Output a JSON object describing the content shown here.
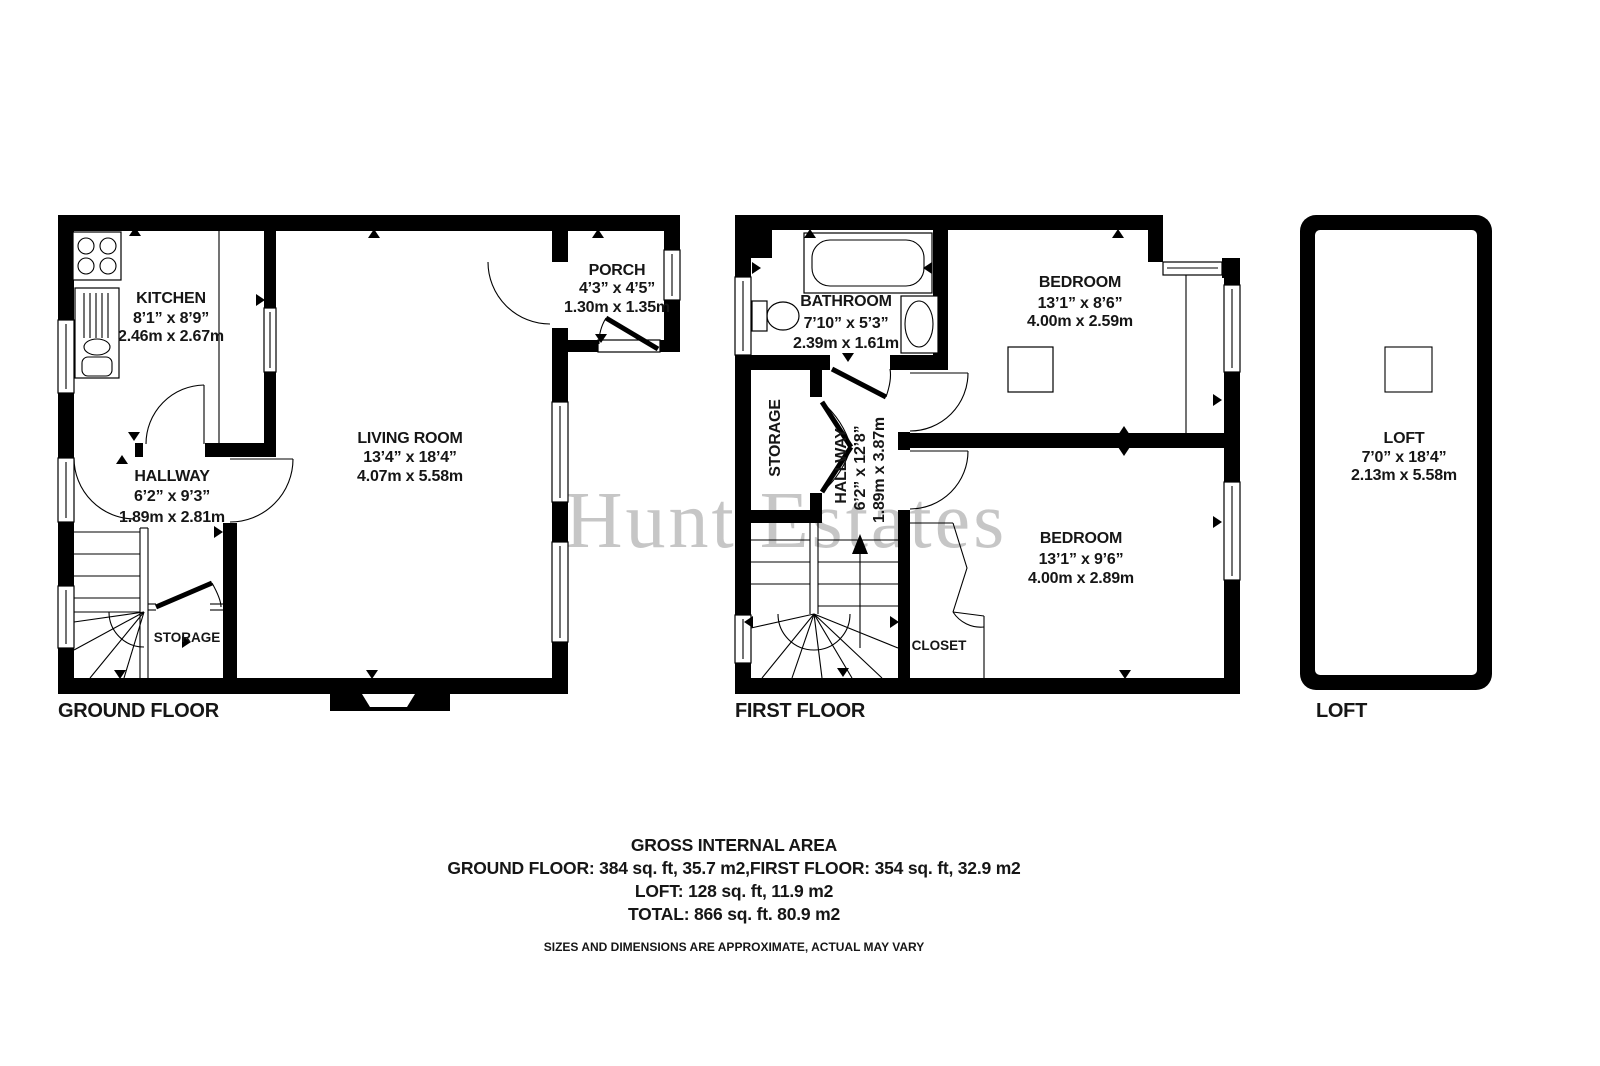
{
  "watermark": "Hunt Estates",
  "ground_floor": {
    "label": "GROUND FLOOR",
    "kitchen": {
      "name": "KITCHEN",
      "imperial": "8’1” x 8’9”",
      "metric": "2.46m x 2.67m"
    },
    "living_room": {
      "name": "LIVING ROOM",
      "imperial": "13’4” x 18’4”",
      "metric": "4.07m x 5.58m"
    },
    "porch": {
      "name": "PORCH",
      "imperial": "4’3” x 4’5”",
      "metric": "1.30m x 1.35m"
    },
    "hallway": {
      "name": "HALLWAY",
      "imperial": "6’2” x 9’3”",
      "metric": "1.89m x 2.81m"
    },
    "storage": {
      "name": "STORAGE"
    }
  },
  "first_floor": {
    "label": "FIRST FLOOR",
    "bathroom": {
      "name": "BATHROOM",
      "imperial": "7’10” x 5’3”",
      "metric": "2.39m x 1.61m"
    },
    "bedroom_front": {
      "name": "BEDROOM",
      "imperial": "13’1” x 8’6”",
      "metric": "4.00m x 2.59m"
    },
    "bedroom_rear": {
      "name": "BEDROOM",
      "imperial": "13’1” x 9’6”",
      "metric": "4.00m x 2.89m"
    },
    "hallway": {
      "name": "HALLWAY",
      "imperial": "6’2” x 12’8”",
      "metric": "1.89m x 3.87m"
    },
    "storage": {
      "name": "STORAGE"
    },
    "closet": {
      "name": "CLOSET"
    }
  },
  "loft": {
    "label": "LOFT",
    "room": {
      "name": "LOFT",
      "imperial": "7’0” x 18’4”",
      "metric": "2.13m x 5.58m"
    }
  },
  "summary": {
    "title": "GROSS INTERNAL AREA",
    "areas": "GROUND FLOOR: 384 sq. ft, 35.7 m2,FIRST FLOOR: 354 sq. ft, 32.9 m2",
    "loft_area": "LOFT: 128 sq. ft, 11.9 m2",
    "total": "TOTAL: 866 sq. ft. 80.9 m2",
    "disclaimer": "SIZES AND DIMENSIONS ARE APPROXIMATE, ACTUAL MAY VARY"
  }
}
